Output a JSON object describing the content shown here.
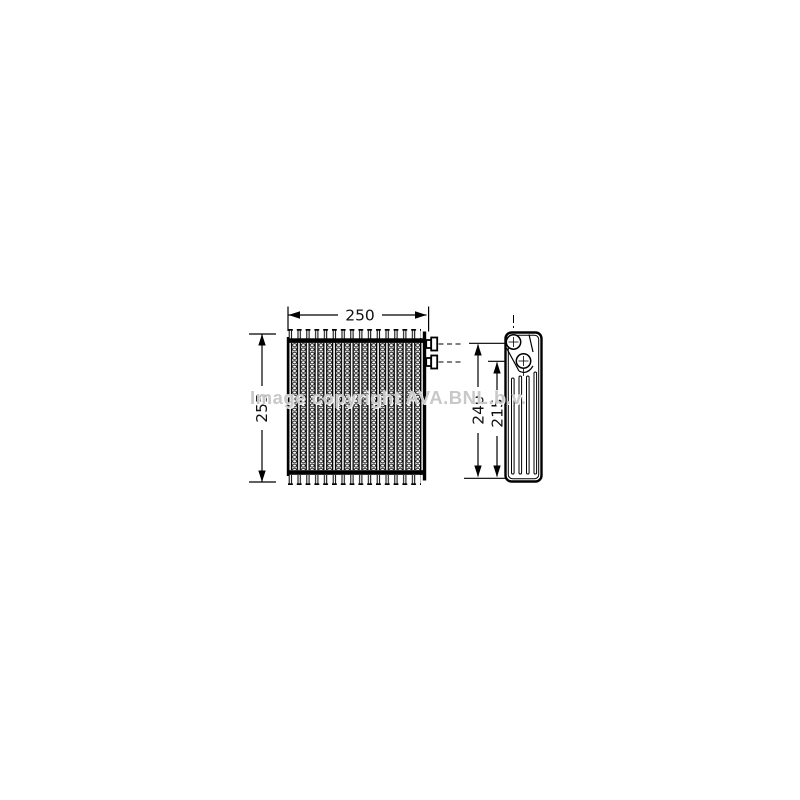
{
  "drawing": {
    "type": "technical-drawing",
    "subject": "air-conditioning-evaporator",
    "watermark": {
      "text": "Image copyright AVA.BNL.b.v.",
      "color": "#c8c8c8"
    },
    "colors": {
      "line": "#000000",
      "background": "#ffffff"
    },
    "front_view": {
      "width_dim": "250",
      "height_dim": "255",
      "tube_count": 16,
      "fittings": 2
    },
    "side_view": {
      "overall_height_dim": "240",
      "port_height_dim": "215",
      "ports": 2,
      "grooves": 4
    }
  }
}
